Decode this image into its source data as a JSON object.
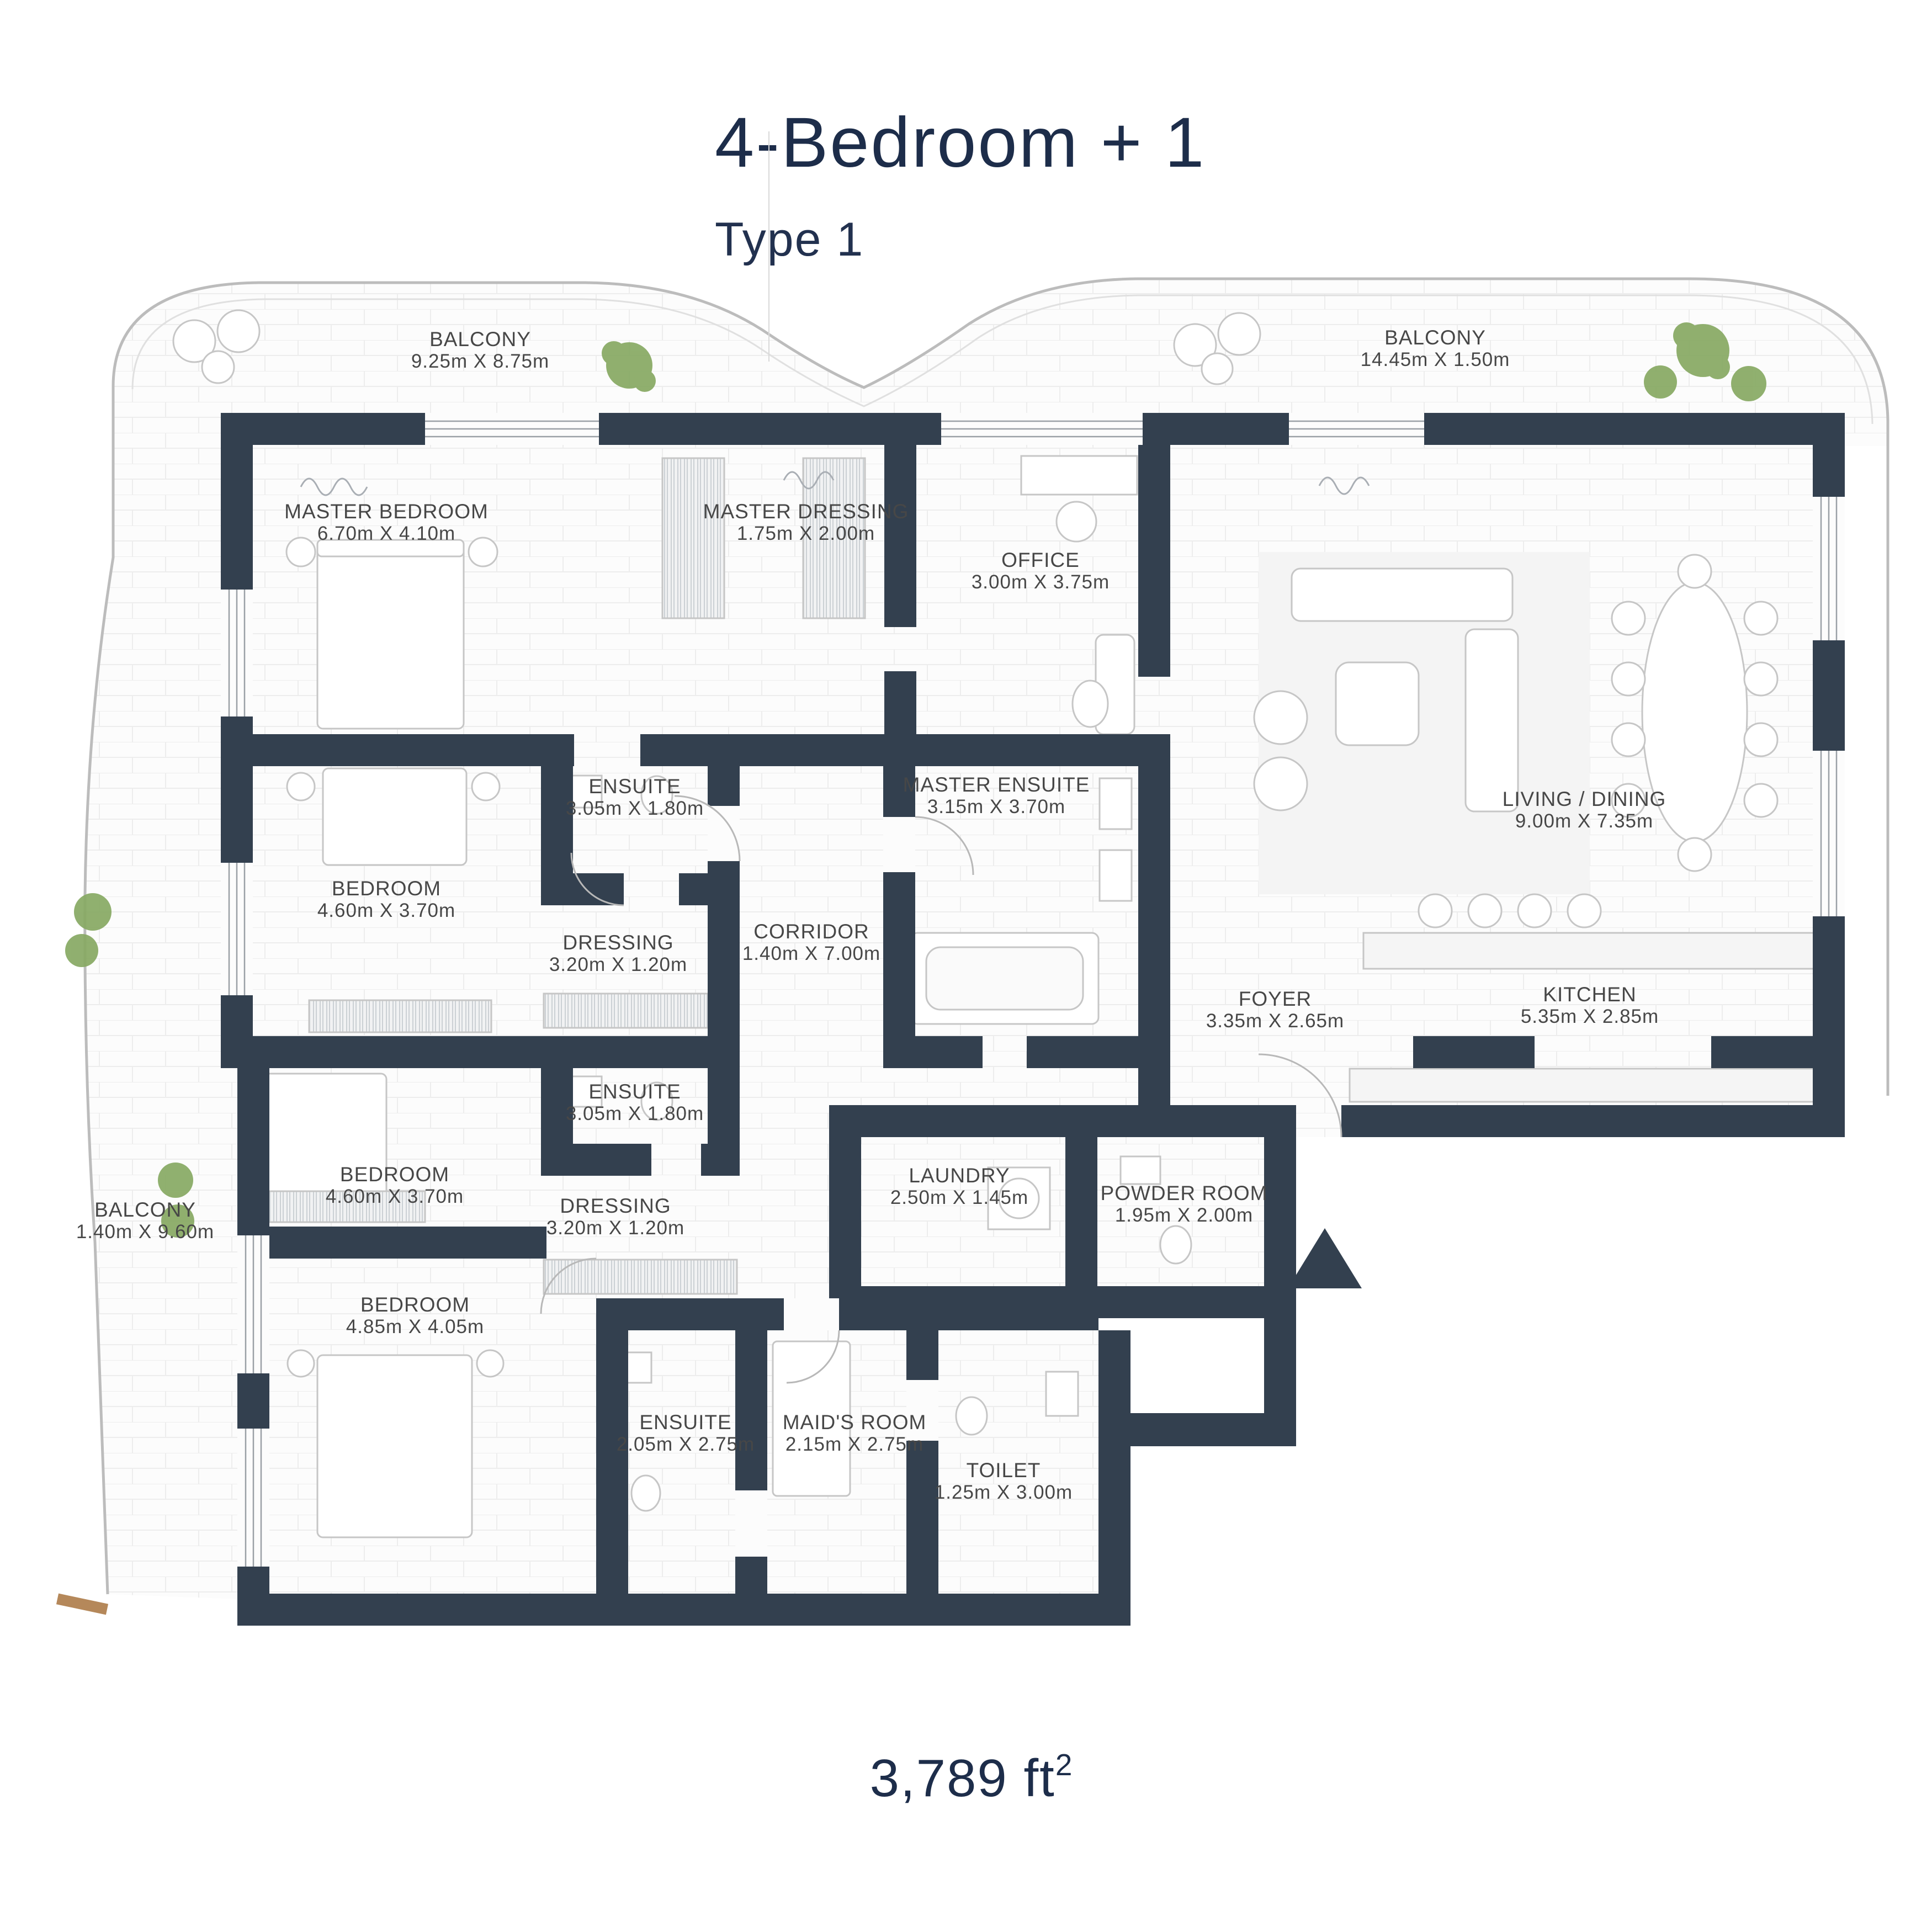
{
  "header": {
    "title": "4-Bedroom + 1",
    "subtitle": "Type 1"
  },
  "footer": {
    "area_value": "3,789 ft",
    "area_sup": "2"
  },
  "colors": {
    "wall": "#33404f",
    "title_text": "#1d2d4a",
    "label_text": "#474747",
    "tree": "#87a963",
    "outline": "#bcbcbc",
    "wood_deck": "#b5885a"
  },
  "icons": {
    "entrance": "entrance-triangle",
    "vegetation": "tree-canopy"
  },
  "rooms": [
    {
      "id": "balcony-top-left",
      "name": "BALCONY",
      "dims": "9.25m X 8.75m"
    },
    {
      "id": "balcony-top-right",
      "name": "BALCONY",
      "dims": "14.45m X 1.50m"
    },
    {
      "id": "master-bedroom",
      "name": "MASTER BEDROOM",
      "dims": "6.70m X 4.10m"
    },
    {
      "id": "master-dressing",
      "name": "MASTER DRESSING",
      "dims": "1.75m X 2.00m"
    },
    {
      "id": "office",
      "name": "OFFICE",
      "dims": "3.00m X 3.75m"
    },
    {
      "id": "ensuite-1",
      "name": "ENSUITE",
      "dims": "3.05m X 1.80m"
    },
    {
      "id": "master-ensuite",
      "name": "MASTER ENSUITE",
      "dims": "3.15m X 3.70m"
    },
    {
      "id": "bedroom-1",
      "name": "BEDROOM",
      "dims": "4.60m X 3.70m"
    },
    {
      "id": "dressing-1",
      "name": "DRESSING",
      "dims": "3.20m X 1.20m"
    },
    {
      "id": "corridor",
      "name": "CORRIDOR",
      "dims": "1.40m X 7.00m"
    },
    {
      "id": "living-dining",
      "name": "LIVING / DINING",
      "dims": "9.00m X 7.35m"
    },
    {
      "id": "foyer",
      "name": "FOYER",
      "dims": "3.35m X 2.65m"
    },
    {
      "id": "kitchen",
      "name": "KITCHEN",
      "dims": "5.35m X 2.85m"
    },
    {
      "id": "ensuite-2",
      "name": "ENSUITE",
      "dims": "3.05m X 1.80m"
    },
    {
      "id": "dressing-2",
      "name": "DRESSING",
      "dims": "3.20m X 1.20m"
    },
    {
      "id": "bedroom-2",
      "name": "BEDROOM",
      "dims": "4.60m X 3.70m"
    },
    {
      "id": "laundry",
      "name": "LAUNDRY",
      "dims": "2.50m X 1.45m"
    },
    {
      "id": "powder-room",
      "name": "POWDER ROOM",
      "dims": "1.95m X 2.00m"
    },
    {
      "id": "balcony-left",
      "name": "BALCONY",
      "dims": "1.40m X 9.60m"
    },
    {
      "id": "bedroom-3",
      "name": "BEDROOM",
      "dims": "4.85m X 4.05m"
    },
    {
      "id": "ensuite-3",
      "name": "ENSUITE",
      "dims": "2.05m X 2.75m"
    },
    {
      "id": "maids-room",
      "name": "MAID'S ROOM",
      "dims": "2.15m X 2.75m"
    },
    {
      "id": "toilet",
      "name": "TOILET",
      "dims": "1.25m X 3.00m"
    }
  ]
}
